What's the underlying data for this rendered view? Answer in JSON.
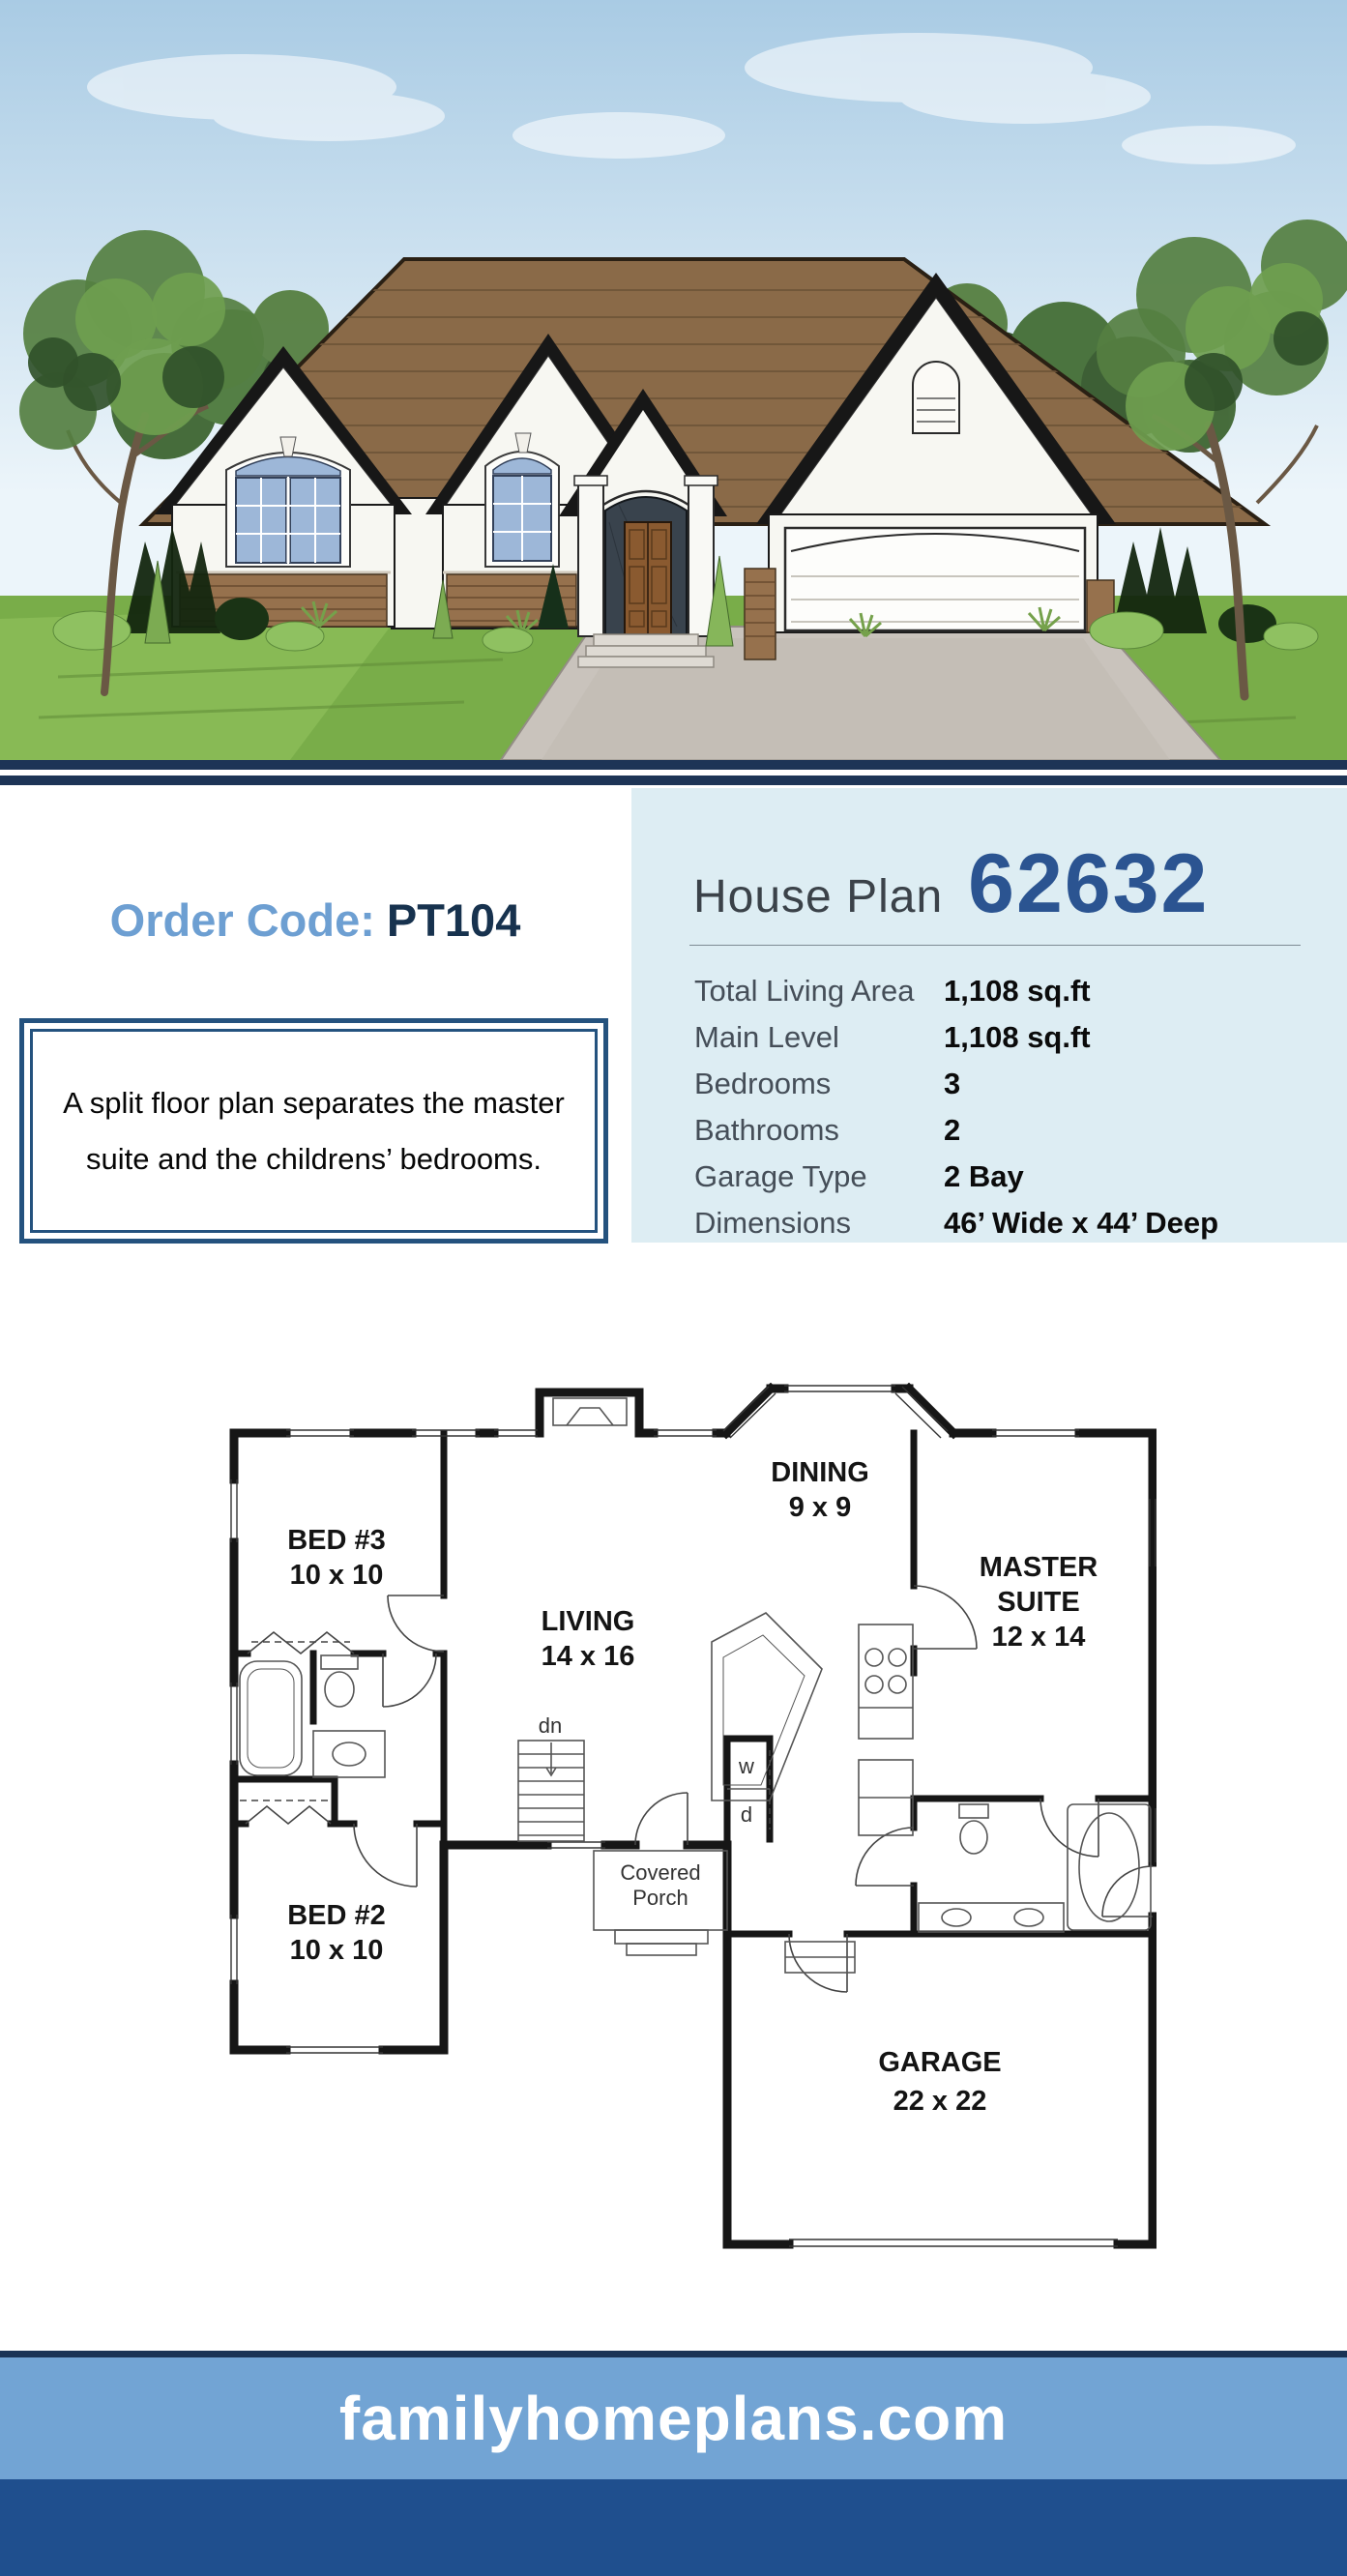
{
  "order": {
    "label": "Order Code:",
    "code": "PT104"
  },
  "description": {
    "text": "A split floor plan separates the master suite and the childrens’ bedrooms."
  },
  "plan": {
    "title": "House Plan",
    "number": "62632"
  },
  "specs": [
    {
      "label": "Total Living Area",
      "value": "1,108 sq.ft"
    },
    {
      "label": "Main Level",
      "value": "1,108 sq.ft"
    },
    {
      "label": "Bedrooms",
      "value": "3"
    },
    {
      "label": "Bathrooms",
      "value": "2"
    },
    {
      "label": "Garage Type",
      "value": "2 Bay"
    },
    {
      "label": "Dimensions",
      "value": "46’ Wide x 44’ Deep"
    }
  ],
  "floor_plan": {
    "rooms": {
      "bed3": {
        "name": "BED #3",
        "size": "10 x 10"
      },
      "living": {
        "name": "LIVING",
        "size": "14 x 16"
      },
      "dining": {
        "name": "DINING",
        "size": "9 x 9"
      },
      "master": {
        "name1": "MASTER",
        "name2": "SUITE",
        "size": "12 x 14"
      },
      "bed2": {
        "name": "BED #2",
        "size": "10 x 10"
      },
      "garage": {
        "name": "GARAGE",
        "size": "22 x 22"
      }
    },
    "porch": {
      "line1": "Covered",
      "line2": "Porch"
    },
    "notes": {
      "stairs": "dn",
      "washer": "w",
      "dryer": "d"
    }
  },
  "footer": {
    "site": "familyhomeplans.com"
  },
  "colors": {
    "divider_navy": "#1d3456",
    "panel_bg": "#ddedf3",
    "plan_number_blue": "#2b5491",
    "order_label_blue": "#6d9fd2",
    "order_code_navy": "#17324e",
    "desc_border_navy": "#24527e",
    "footer_band_blue": "#72a4d4",
    "footer_dark_blue": "#1f4f8e"
  }
}
